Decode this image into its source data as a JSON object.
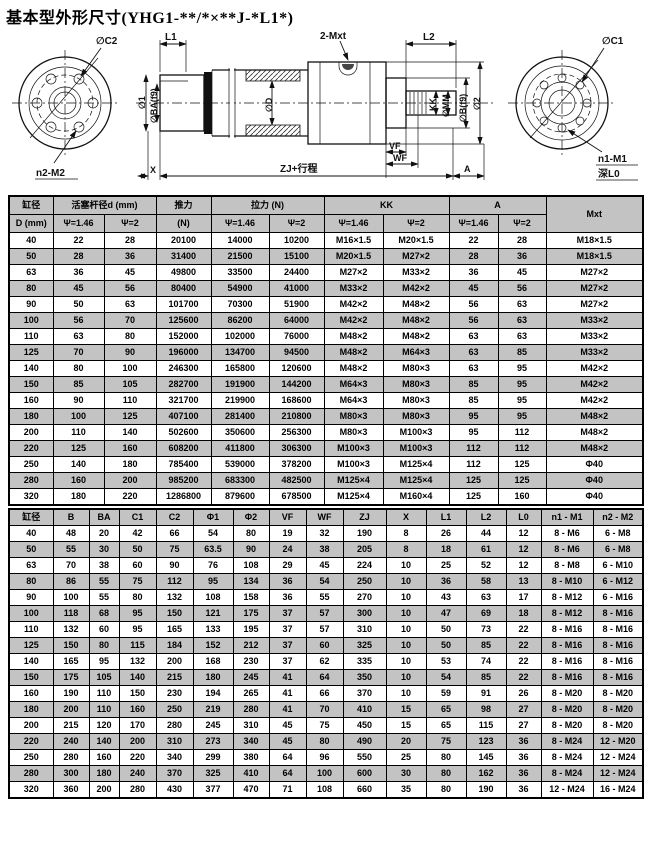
{
  "title": "基本型外形尺寸(YHG1-**/*×**J-*L1*)",
  "colors": {
    "row_shade": "#c3c3c3",
    "border": "#000000",
    "background": "#ffffff"
  },
  "drawing": {
    "labels": {
      "c2": "∅C2",
      "n2_m2": "n2-M2",
      "l1": "L1",
      "mxt2": "2-Mxt",
      "l2": "L2",
      "dia1": "∅1",
      "ba": "∅BA(f9)",
      "dd": "∅D",
      "kk": "KK",
      "mm": "∅MM",
      "b": "∅B(f9)",
      "dia2": "∅2",
      "vf": "VF",
      "wf": "WF",
      "zj": "ZJ+行程",
      "a": "A",
      "x": "X",
      "c1": "∅C1",
      "n1_m1": "n1-M1",
      "l0": "深L0"
    }
  },
  "table1": {
    "header": {
      "bore_top": "缸径",
      "bore_bottom": "D (mm)",
      "rod_dia": "活塞杆径d (mm)",
      "thrust_top": "推力",
      "thrust_bottom": "(N)",
      "pull": "拉力 (N)",
      "kk": "KK",
      "a": "A",
      "mxt": "Mxt",
      "psi1": "Ψ=1.46",
      "psi2": "Ψ=2"
    },
    "rows": [
      [
        "40",
        "22",
        "28",
        "20100",
        "14000",
        "10200",
        "M16×1.5",
        "M20×1.5",
        "22",
        "28",
        "M18×1.5"
      ],
      [
        "50",
        "28",
        "36",
        "31400",
        "21500",
        "15100",
        "M20×1.5",
        "M27×2",
        "28",
        "36",
        "M18×1.5"
      ],
      [
        "63",
        "36",
        "45",
        "49800",
        "33500",
        "24400",
        "M27×2",
        "M33×2",
        "36",
        "45",
        "M27×2"
      ],
      [
        "80",
        "45",
        "56",
        "80400",
        "54900",
        "41000",
        "M33×2",
        "M42×2",
        "45",
        "56",
        "M27×2"
      ],
      [
        "90",
        "50",
        "63",
        "101700",
        "70300",
        "51900",
        "M42×2",
        "M48×2",
        "56",
        "63",
        "M27×2"
      ],
      [
        "100",
        "56",
        "70",
        "125600",
        "86200",
        "64000",
        "M42×2",
        "M48×2",
        "56",
        "63",
        "M33×2"
      ],
      [
        "110",
        "63",
        "80",
        "152000",
        "102000",
        "76000",
        "M48×2",
        "M48×2",
        "63",
        "63",
        "M33×2"
      ],
      [
        "125",
        "70",
        "90",
        "196000",
        "134700",
        "94500",
        "M48×2",
        "M64×3",
        "63",
        "85",
        "M33×2"
      ],
      [
        "140",
        "80",
        "100",
        "246300",
        "165800",
        "120600",
        "M48×2",
        "M80×3",
        "63",
        "95",
        "M42×2"
      ],
      [
        "150",
        "85",
        "105",
        "282700",
        "191900",
        "144200",
        "M64×3",
        "M80×3",
        "85",
        "95",
        "M42×2"
      ],
      [
        "160",
        "90",
        "110",
        "321700",
        "219900",
        "168600",
        "M64×3",
        "M80×3",
        "85",
        "95",
        "M42×2"
      ],
      [
        "180",
        "100",
        "125",
        "407100",
        "281400",
        "210800",
        "M80×3",
        "M80×3",
        "95",
        "95",
        "M48×2"
      ],
      [
        "200",
        "110",
        "140",
        "502600",
        "350600",
        "256300",
        "M80×3",
        "M100×3",
        "95",
        "112",
        "M48×2"
      ],
      [
        "220",
        "125",
        "160",
        "608200",
        "411800",
        "306300",
        "M100×3",
        "M100×3",
        "112",
        "112",
        "M48×2"
      ],
      [
        "250",
        "140",
        "180",
        "785400",
        "539000",
        "378200",
        "M100×3",
        "M125×4",
        "112",
        "125",
        "Φ40"
      ],
      [
        "280",
        "160",
        "200",
        "985200",
        "683300",
        "482500",
        "M125×4",
        "M125×4",
        "125",
        "125",
        "Φ40"
      ],
      [
        "320",
        "180",
        "220",
        "1286800",
        "879600",
        "678500",
        "M125×4",
        "M160×4",
        "125",
        "160",
        "Φ40"
      ]
    ]
  },
  "table2": {
    "header": [
      "缸径",
      "B",
      "BA",
      "C1",
      "C2",
      "Φ1",
      "Φ2",
      "VF",
      "WF",
      "ZJ",
      "X",
      "L1",
      "L2",
      "L0",
      "n1 - M1",
      "n2 - M2"
    ],
    "rows": [
      [
        "40",
        "48",
        "20",
        "42",
        "66",
        "54",
        "80",
        "19",
        "32",
        "190",
        "8",
        "26",
        "44",
        "12",
        "8 - M6",
        "6 - M8"
      ],
      [
        "50",
        "55",
        "30",
        "50",
        "75",
        "63.5",
        "90",
        "24",
        "38",
        "205",
        "8",
        "18",
        "61",
        "12",
        "8 - M6",
        "6 - M8"
      ],
      [
        "63",
        "70",
        "38",
        "60",
        "90",
        "76",
        "108",
        "29",
        "45",
        "224",
        "10",
        "25",
        "52",
        "12",
        "8 - M8",
        "6 - M10"
      ],
      [
        "80",
        "86",
        "55",
        "75",
        "112",
        "95",
        "134",
        "36",
        "54",
        "250",
        "10",
        "36",
        "58",
        "13",
        "8 - M10",
        "6 - M12"
      ],
      [
        "90",
        "100",
        "55",
        "80",
        "132",
        "108",
        "158",
        "36",
        "55",
        "270",
        "10",
        "43",
        "63",
        "17",
        "8 - M12",
        "6 - M16"
      ],
      [
        "100",
        "118",
        "68",
        "95",
        "150",
        "121",
        "175",
        "37",
        "57",
        "300",
        "10",
        "47",
        "69",
        "18",
        "8 - M12",
        "8 - M16"
      ],
      [
        "110",
        "132",
        "60",
        "95",
        "165",
        "133",
        "195",
        "37",
        "57",
        "310",
        "10",
        "50",
        "73",
        "22",
        "8 - M16",
        "8 - M16"
      ],
      [
        "125",
        "150",
        "80",
        "115",
        "184",
        "152",
        "212",
        "37",
        "60",
        "325",
        "10",
        "50",
        "85",
        "22",
        "8 - M16",
        "8 - M16"
      ],
      [
        "140",
        "165",
        "95",
        "132",
        "200",
        "168",
        "230",
        "37",
        "62",
        "335",
        "10",
        "53",
        "74",
        "22",
        "8 - M16",
        "8 - M16"
      ],
      [
        "150",
        "175",
        "105",
        "140",
        "215",
        "180",
        "245",
        "41",
        "64",
        "350",
        "10",
        "54",
        "85",
        "22",
        "8 - M16",
        "8 - M16"
      ],
      [
        "160",
        "190",
        "110",
        "150",
        "230",
        "194",
        "265",
        "41",
        "66",
        "370",
        "10",
        "59",
        "91",
        "26",
        "8 - M20",
        "8 - M20"
      ],
      [
        "180",
        "200",
        "110",
        "160",
        "250",
        "219",
        "280",
        "41",
        "70",
        "410",
        "15",
        "65",
        "98",
        "27",
        "8 - M20",
        "8 - M20"
      ],
      [
        "200",
        "215",
        "120",
        "170",
        "280",
        "245",
        "310",
        "45",
        "75",
        "450",
        "15",
        "65",
        "115",
        "27",
        "8 - M20",
        "8 - M20"
      ],
      [
        "220",
        "240",
        "140",
        "200",
        "310",
        "273",
        "340",
        "45",
        "80",
        "490",
        "20",
        "75",
        "123",
        "36",
        "8 - M24",
        "12 - M20"
      ],
      [
        "250",
        "280",
        "160",
        "220",
        "340",
        "299",
        "380",
        "64",
        "96",
        "550",
        "25",
        "80",
        "145",
        "36",
        "8 - M24",
        "12 - M24"
      ],
      [
        "280",
        "300",
        "180",
        "240",
        "370",
        "325",
        "410",
        "64",
        "100",
        "600",
        "30",
        "80",
        "162",
        "36",
        "8 - M24",
        "12 - M24"
      ],
      [
        "320",
        "360",
        "200",
        "280",
        "430",
        "377",
        "470",
        "71",
        "108",
        "660",
        "35",
        "80",
        "190",
        "36",
        "12 - M24",
        "16 - M24"
      ]
    ]
  }
}
